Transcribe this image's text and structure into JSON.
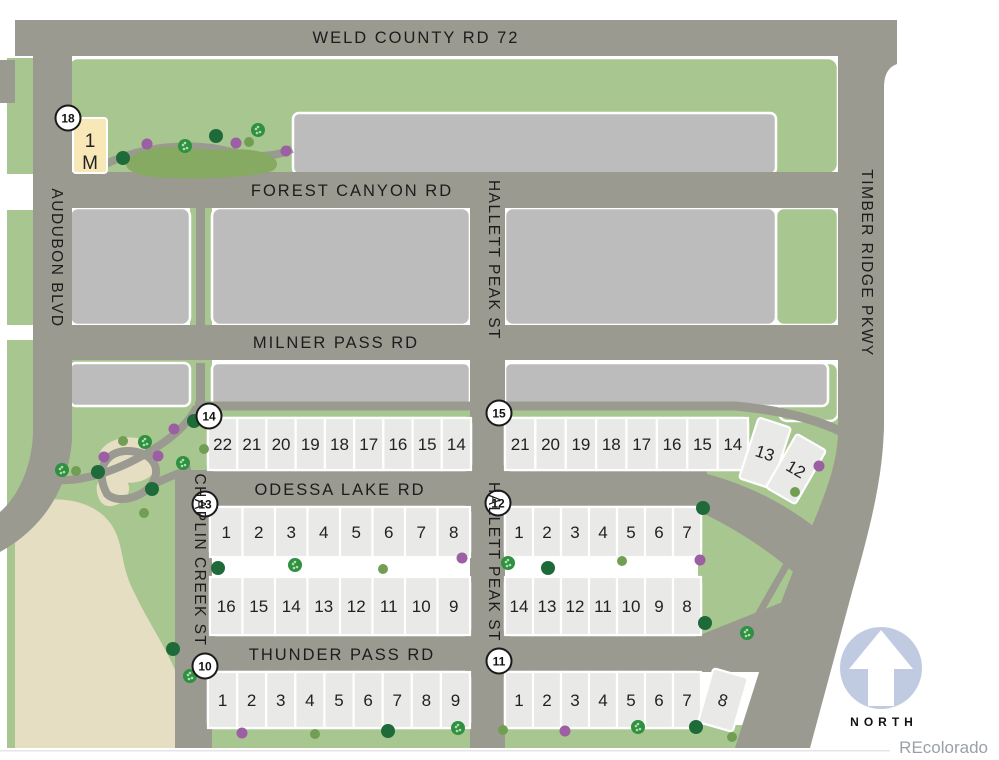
{
  "palette": {
    "road": "#9a9a90",
    "parcel": "#bcbcbc",
    "lot": "#e9e9e7",
    "green": "#a8c68f",
    "pond": "#87aa63",
    "beige": "#e5dec2",
    "tan_lot": "#f8e8b8",
    "tree_dark": "#1e6a39",
    "tree_sage": "#729e54",
    "tree_star": "#2f9040",
    "tree_purple": "#9c5fa4",
    "north_badge": "#c0cbe2",
    "watermark_gray": "#9aa0a6"
  },
  "roads": {
    "weld_county": "WELD COUNTY RD 72",
    "forest_canyon": "FOREST CANYON RD",
    "milner_pass": "MILNER PASS RD",
    "odessa_lake": "ODESSA LAKE RD",
    "thunder_pass": "THUNDER PASS RD",
    "audubon": "AUDUBON BLVD",
    "hallett_upper": "HALLETT PEAK ST",
    "hallett_lower": "HALLETT PEAK ST",
    "chaplin": "CHAPLIN CREEK ST",
    "timber_ridge": "TIMBER RIDGE PKWY"
  },
  "block18": {
    "badge": "18",
    "badge_x": 68,
    "badge_y": 118,
    "lot_top": "1",
    "lot_bottom": "M"
  },
  "blocks": [
    {
      "badge": "14",
      "badge_x": 209,
      "badge_y": 416,
      "rows": [
        {
          "x": 208,
          "y": 418,
          "w": 263,
          "h": 52,
          "lots": [
            "22",
            "21",
            "20",
            "19",
            "18",
            "17",
            "16",
            "15",
            "14"
          ]
        }
      ]
    },
    {
      "badge": "15",
      "badge_x": 499,
      "badge_y": 413,
      "rows": [
        {
          "x": 505,
          "y": 418,
          "w": 243,
          "h": 52,
          "lots": [
            "21",
            "20",
            "19",
            "18",
            "17",
            "16",
            "15",
            "14"
          ]
        }
      ],
      "angled": [
        {
          "lot": "13",
          "cx": 765,
          "cy": 453,
          "w": 34,
          "h": 64,
          "rot": 18
        },
        {
          "lot": "12",
          "cx": 796,
          "cy": 469,
          "w": 34,
          "h": 62,
          "rot": 30
        }
      ]
    },
    {
      "badge": "13",
      "badge_x": 205,
      "badge_y": 504,
      "rows": [
        {
          "x": 210,
          "y": 507,
          "w": 260,
          "h": 50,
          "lots": [
            "1",
            "2",
            "3",
            "4",
            "5",
            "6",
            "7",
            "8"
          ]
        },
        {
          "x": 210,
          "y": 577,
          "w": 260,
          "h": 58,
          "lots": [
            "16",
            "15",
            "14",
            "13",
            "12",
            "11",
            "10",
            "9"
          ]
        }
      ]
    },
    {
      "badge": "12",
      "badge_x": 498,
      "badge_y": 503,
      "rows": [
        {
          "x": 505,
          "y": 507,
          "w": 196,
          "h": 50,
          "lots": [
            "1",
            "2",
            "3",
            "4",
            "5",
            "6",
            "7"
          ]
        },
        {
          "x": 505,
          "y": 577,
          "w": 196,
          "h": 58,
          "lots": [
            "14",
            "13",
            "12",
            "11",
            "10",
            "9",
            "8"
          ]
        }
      ]
    },
    {
      "badge": "10",
      "badge_x": 205,
      "badge_y": 666,
      "rows": [
        {
          "x": 208,
          "y": 672,
          "w": 262,
          "h": 56,
          "lots": [
            "1",
            "2",
            "3",
            "4",
            "5",
            "6",
            "7",
            "8",
            "9"
          ]
        }
      ]
    },
    {
      "badge": "11",
      "badge_x": 499,
      "badge_y": 661,
      "rows": [
        {
          "x": 505,
          "y": 672,
          "w": 196,
          "h": 56,
          "lots": [
            "1",
            "2",
            "3",
            "4",
            "5",
            "6",
            "7"
          ]
        }
      ],
      "angled": [
        {
          "lot": "8",
          "cx": 723,
          "cy": 700,
          "w": 36,
          "h": 56,
          "rot": 16
        }
      ]
    }
  ],
  "trees": [
    {
      "t": "dark",
      "x": 123,
      "y": 158
    },
    {
      "t": "purple",
      "x": 147,
      "y": 144
    },
    {
      "t": "star",
      "x": 185,
      "y": 146
    },
    {
      "t": "dark",
      "x": 216,
      "y": 136
    },
    {
      "t": "purple",
      "x": 236,
      "y": 143
    },
    {
      "t": "sage",
      "x": 249,
      "y": 142
    },
    {
      "t": "star",
      "x": 258,
      "y": 130
    },
    {
      "t": "purple",
      "x": 286,
      "y": 151
    },
    {
      "t": "dark",
      "x": 194,
      "y": 421
    },
    {
      "t": "purple",
      "x": 174,
      "y": 429
    },
    {
      "t": "sage",
      "x": 123,
      "y": 441
    },
    {
      "t": "star",
      "x": 145,
      "y": 442
    },
    {
      "t": "purple",
      "x": 104,
      "y": 457
    },
    {
      "t": "purple",
      "x": 158,
      "y": 456
    },
    {
      "t": "star",
      "x": 183,
      "y": 463
    },
    {
      "t": "sage",
      "x": 204,
      "y": 449
    },
    {
      "t": "dark",
      "x": 98,
      "y": 472
    },
    {
      "t": "star",
      "x": 62,
      "y": 470
    },
    {
      "t": "sage",
      "x": 76,
      "y": 471
    },
    {
      "t": "dark",
      "x": 152,
      "y": 489
    },
    {
      "t": "sage",
      "x": 144,
      "y": 513
    },
    {
      "t": "dark",
      "x": 173,
      "y": 649
    },
    {
      "t": "star",
      "x": 190,
      "y": 676
    },
    {
      "t": "purple",
      "x": 819,
      "y": 466
    },
    {
      "t": "sage",
      "x": 795,
      "y": 492
    },
    {
      "t": "dark",
      "x": 703,
      "y": 508
    },
    {
      "t": "purple",
      "x": 700,
      "y": 560
    },
    {
      "t": "dark",
      "x": 705,
      "y": 623
    },
    {
      "t": "star",
      "x": 747,
      "y": 633
    },
    {
      "t": "dark",
      "x": 218,
      "y": 568
    },
    {
      "t": "star",
      "x": 295,
      "y": 565
    },
    {
      "t": "sage",
      "x": 383,
      "y": 569
    },
    {
      "t": "purple",
      "x": 462,
      "y": 558
    },
    {
      "t": "star",
      "x": 508,
      "y": 563
    },
    {
      "t": "dark",
      "x": 548,
      "y": 568
    },
    {
      "t": "sage",
      "x": 622,
      "y": 561
    },
    {
      "t": "purple",
      "x": 242,
      "y": 733
    },
    {
      "t": "sage",
      "x": 315,
      "y": 734
    },
    {
      "t": "dark",
      "x": 388,
      "y": 731
    },
    {
      "t": "star",
      "x": 458,
      "y": 728
    },
    {
      "t": "sage",
      "x": 503,
      "y": 730
    },
    {
      "t": "purple",
      "x": 565,
      "y": 731
    },
    {
      "t": "star",
      "x": 638,
      "y": 727
    },
    {
      "t": "dark",
      "x": 696,
      "y": 727
    },
    {
      "t": "sage",
      "x": 732,
      "y": 737
    }
  ],
  "north": {
    "label": "NORTH"
  },
  "watermark": "REcolorado"
}
